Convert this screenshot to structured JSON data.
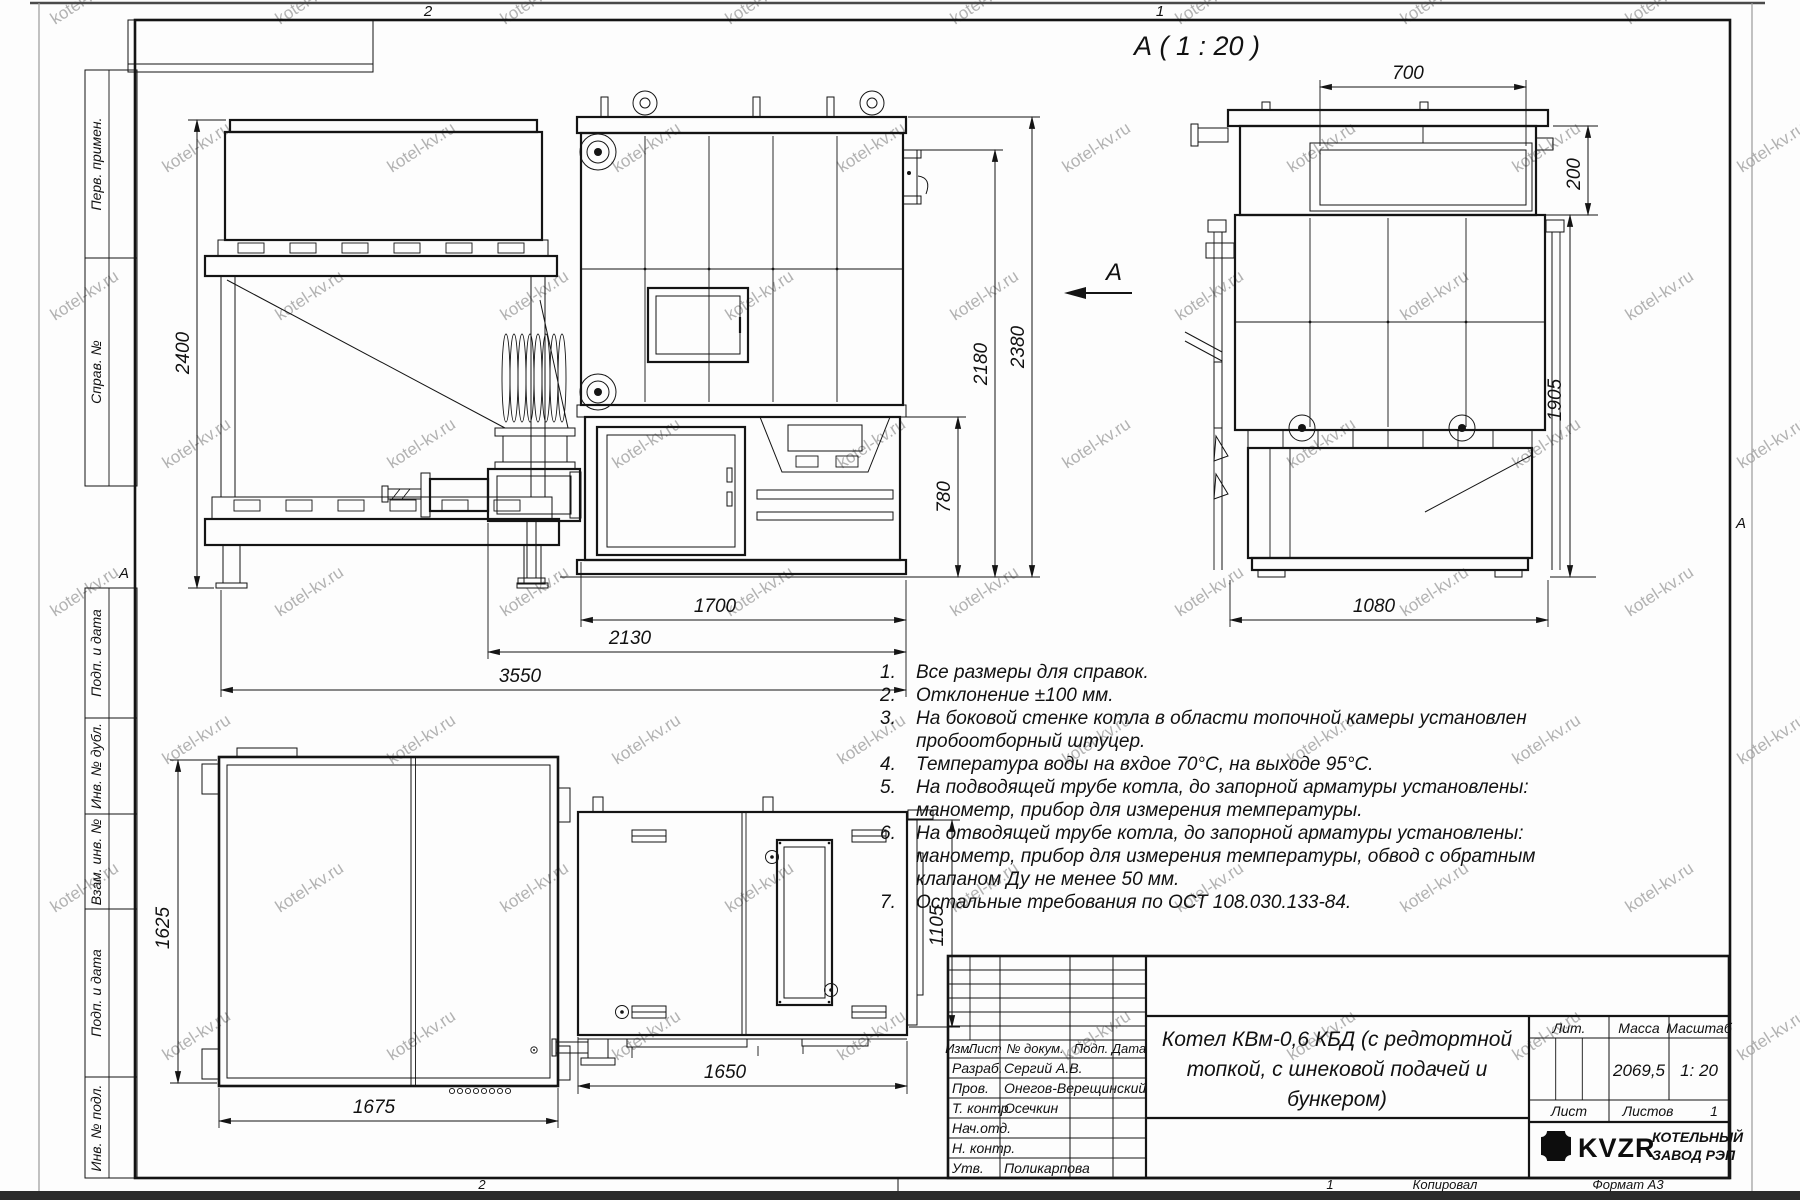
{
  "watermark": {
    "text": "kotel-kv.ru"
  },
  "frame": {
    "zone_top_left": "2",
    "zone_top_right": "1",
    "zone_bottom_left": "2",
    "zone_bottom_right": "1",
    "zone_side_left": "А",
    "zone_side_right": "А",
    "copied_label": "Копировал",
    "format_label": "Формат А3",
    "sidebar_items": [
      "Перв. примен.",
      "Справ. №",
      "Подп. и дата",
      "Инв. № дубл.",
      "Взам. инв. №",
      "Подп. и дата",
      "Инв. № подл."
    ]
  },
  "views": {
    "section_title": "А ( 1 : 20 )",
    "view_arrow_label": "А"
  },
  "dims": {
    "bunker_height": "2400",
    "boiler_length": "1700",
    "feed_length": "2130",
    "total_length": "3550",
    "lower_height": "780",
    "mid_height": "2180",
    "total_height": "2380",
    "section_top_width": "700",
    "section_neck_height": "200",
    "section_height": "1905",
    "section_width": "1080",
    "plan_depth": "1625",
    "plan_width": "1675",
    "side_height": "1105",
    "side_width": "1650"
  },
  "notes": {
    "items": [
      {
        "num": "1.",
        "lines": [
          "Все размеры для справок."
        ]
      },
      {
        "num": "2.",
        "lines": [
          "Отклонение ±100 мм."
        ]
      },
      {
        "num": "3.",
        "lines": [
          "На боковой стенке котла в области топочной камеры установлен",
          "пробоотборный штуцер."
        ]
      },
      {
        "num": "4.",
        "lines": [
          "Температура воды на вхдое 70°С, на выходе 95°С."
        ]
      },
      {
        "num": "5.",
        "lines": [
          "На подводящей трубе котла, до запорной арматуры установлены:",
          "манометр, прибор для измерения температуры."
        ]
      },
      {
        "num": "6.",
        "lines": [
          "На отводящей трубе котла, до запорной арматуры установлены:",
          "манометр, прибор для измерения температуры, обвод с обратным",
          "клапаном Ду не менее 50 мм."
        ]
      },
      {
        "num": "7.",
        "lines": [
          "Остальные требования по ОСТ 108.030.133-84."
        ]
      }
    ]
  },
  "title_block": {
    "header": {
      "izm": "Изм.",
      "list": "Лист",
      "doc": "№ докум.",
      "podp": "Подп.",
      "data": "Дата"
    },
    "rows": [
      {
        "role": "Разраб.",
        "name": "Сергий А.В."
      },
      {
        "role": "Пров.",
        "name": "Онегов-Верещинский"
      },
      {
        "role": "Т. контр.",
        "name": "Осечкин"
      },
      {
        "role": "Нач.отд.",
        "name": ""
      },
      {
        "role": "Н. контр.",
        "name": ""
      },
      {
        "role": "Утв.",
        "name": "Поликарпова"
      }
    ],
    "doc_title_lines": [
      "Котел КВм-0,6 КБД (с редтортной",
      "топкой, с шнековой подачей и",
      "бункером)"
    ],
    "lit_label": "Лит.",
    "mass_label": "Масса",
    "scale_label": "Масштаб",
    "mass_value": "2069,5",
    "scale_value": "1: 20",
    "sheet_label": "Лист",
    "sheets_label": "Листов",
    "sheets_value": "1",
    "brand": {
      "logo_text": "KVZR",
      "name_line1": "КОТЕЛЬНЫЙ",
      "name_line2": "ЗАВОД РЭП"
    }
  }
}
